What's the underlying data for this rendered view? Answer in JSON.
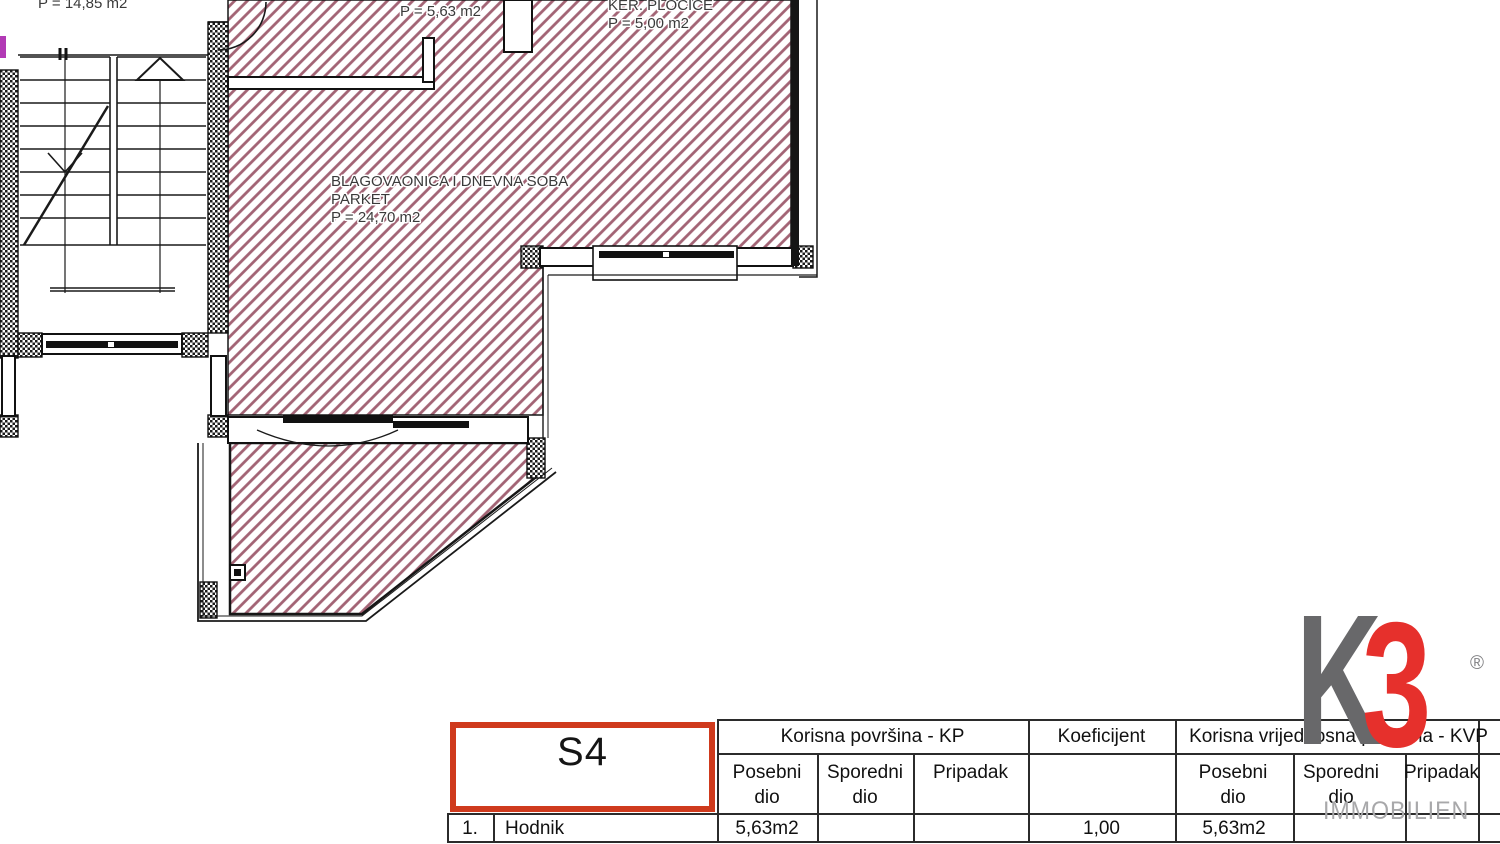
{
  "plan": {
    "stairwell_area_label": "P = 14,85 m2",
    "hallway_area_label": "P = 5,63 m2",
    "kitchen": {
      "name": "KER. PLOČICE",
      "area": "P = 5,00 m2"
    },
    "living_room": {
      "name": "BLAGOVAONICA I DNEVNA SOBA",
      "floor": "PARKET",
      "area": "P = 24,70 m2"
    }
  },
  "table": {
    "unit": "S4",
    "headers": {
      "kp_group": "Korisna površina - KP",
      "koeficijent": "Koeficijent",
      "kvp_group": "Korisna vrijednosna površina - KVP",
      "posebni": "Posebni dio",
      "sporedni": "Sporedni dio",
      "pripadak": "Pripadak"
    },
    "rows": [
      {
        "num": "1.",
        "name": "Hodnik",
        "kp_posebni": "5,63m2",
        "kp_sporedni": "",
        "kp_pripadak": "",
        "koeficijent": "1,00",
        "kvp_posebni": "5,63m2",
        "kvp_sporedni": "",
        "kvp_pripadak": ""
      }
    ]
  },
  "logo": {
    "letter_k": "K",
    "letter_3": "3",
    "registered": "®",
    "word": "IMMOBILIEN"
  },
  "colors": {
    "floor_hatch": "#a26374",
    "unit_box_border": "#cf3a1d",
    "logo_gray": "#68686a",
    "logo_red": "#e6302c",
    "logo_word_gray": "#a8a8aa"
  }
}
